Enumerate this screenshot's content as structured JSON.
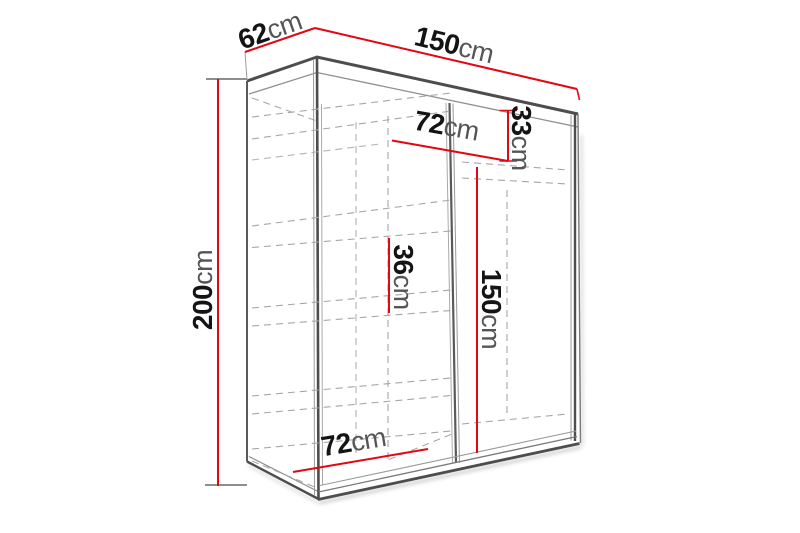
{
  "diagram": {
    "type": "wardrobe-dimension-drawing",
    "colors": {
      "dimension_line": "#e30613",
      "outline": "#4d4d4d",
      "hidden_line": "#a6a6a6",
      "number_text": "#141414",
      "unit_text": "#555555",
      "background": "#ffffff"
    }
  },
  "dimensions": {
    "depth": {
      "value": "62",
      "unit": "cm"
    },
    "width": {
      "value": "150",
      "unit": "cm"
    },
    "height": {
      "value": "200",
      "unit": "cm"
    },
    "upper_shelf_width": {
      "value": "72",
      "unit": "cm"
    },
    "upper_section_height": {
      "value": "33",
      "unit": "cm"
    },
    "shelf_spacing": {
      "value": "36",
      "unit": "cm"
    },
    "hanging_height": {
      "value": "150",
      "unit": "cm"
    },
    "lower_shelf_width": {
      "value": "72",
      "unit": "cm"
    }
  }
}
